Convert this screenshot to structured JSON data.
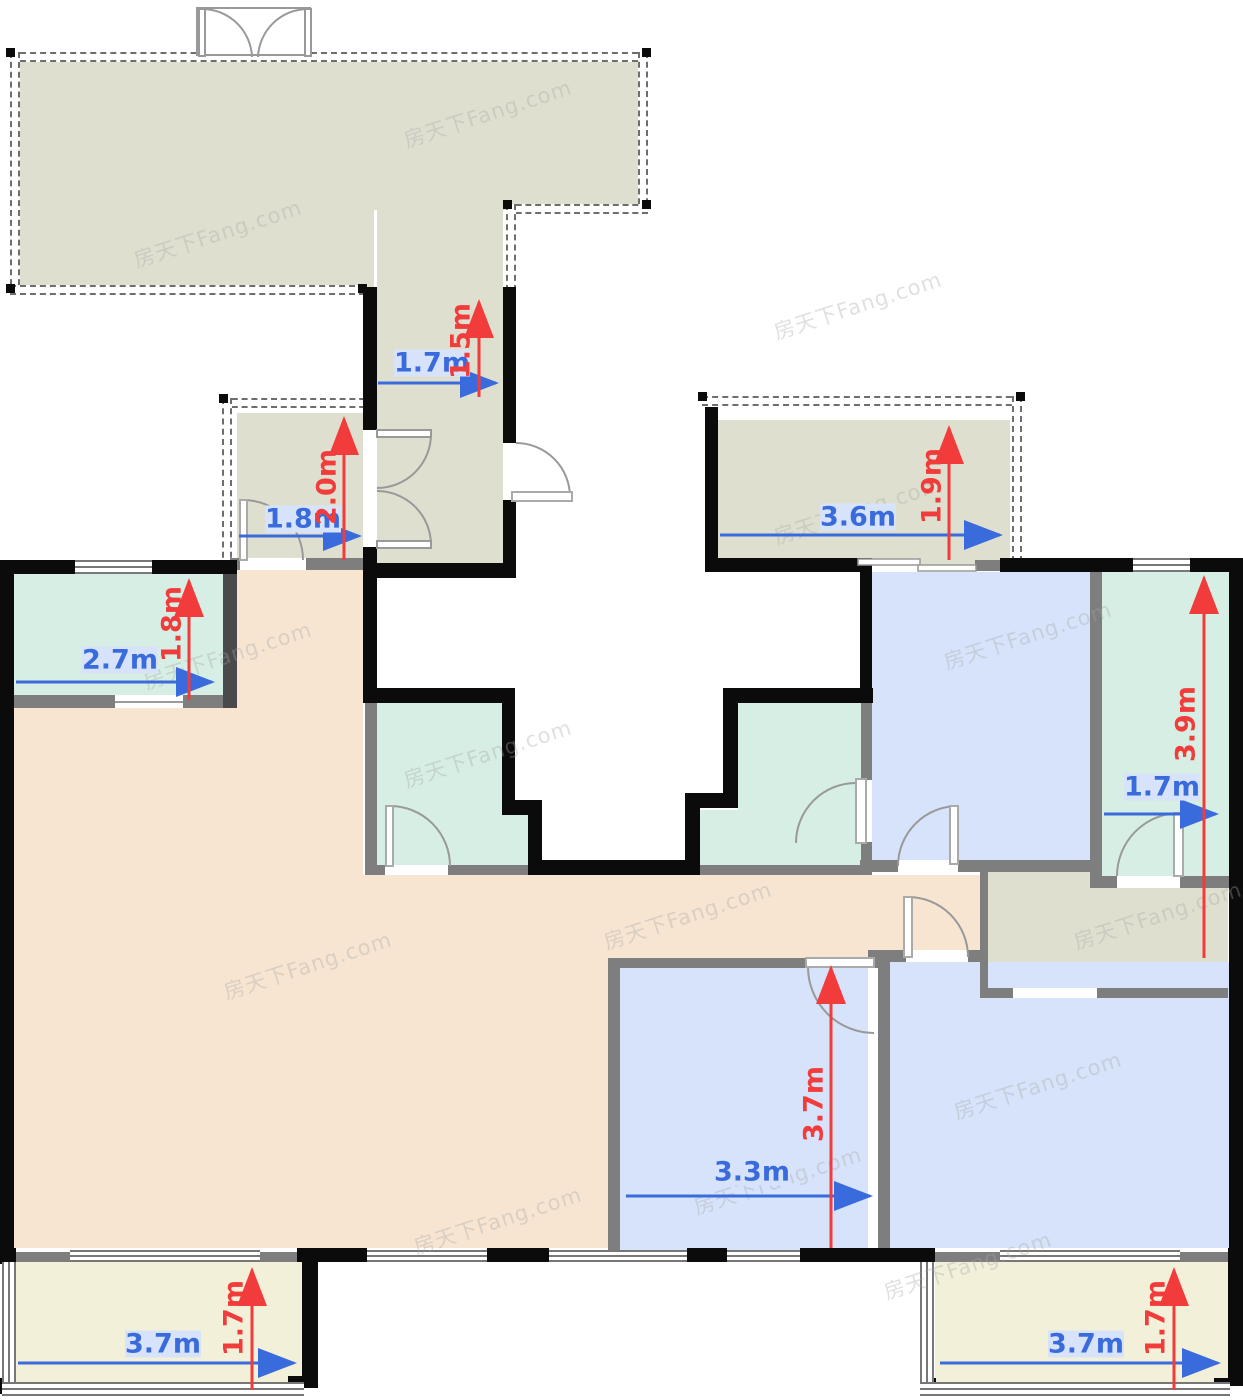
{
  "watermark": {
    "text": "房天下Fang.com"
  },
  "palette": {
    "terrace_khaki": "#DFDFD0",
    "living_beige": "#F7E5D2",
    "bedroom_blue": "#D7E3FA",
    "bath_teal": "#D6EEE3",
    "balcony_cream": "#F2F0D9",
    "wall_black": "#0B0B0B",
    "wall_gray": "#7E7E7E",
    "dim_blue": "#3A6BDC",
    "dim_red": "#F23B3B"
  },
  "dims": [
    {
      "id": "corridor-width",
      "label": "1.7m",
      "axis": "horizontal",
      "color": "blue"
    },
    {
      "id": "corridor-height",
      "label": "1.5m",
      "axis": "vertical",
      "color": "red"
    },
    {
      "id": "storage-room-width",
      "label": "1.8m",
      "axis": "horizontal",
      "color": "blue"
    },
    {
      "id": "storage-room-height",
      "label": "2.0m",
      "axis": "vertical",
      "color": "red"
    },
    {
      "id": "room-top-left-width",
      "label": "2.7m",
      "axis": "horizontal",
      "color": "blue"
    },
    {
      "id": "room-top-left-height",
      "label": "1.8m",
      "axis": "vertical",
      "color": "red"
    },
    {
      "id": "balcony-top-right-width",
      "label": "3.6m",
      "axis": "horizontal",
      "color": "blue"
    },
    {
      "id": "balcony-top-right-height",
      "label": "1.9m",
      "axis": "vertical",
      "color": "red"
    },
    {
      "id": "room-right-width",
      "label": "1.7m",
      "axis": "horizontal",
      "color": "blue"
    },
    {
      "id": "room-right-height",
      "label": "3.9m",
      "axis": "vertical",
      "color": "red"
    },
    {
      "id": "bedroom-middle-width",
      "label": "3.3m",
      "axis": "horizontal",
      "color": "blue"
    },
    {
      "id": "bedroom-middle-height",
      "label": "3.7m",
      "axis": "vertical",
      "color": "red"
    },
    {
      "id": "balcony-bottom-left-width",
      "label": "3.7m",
      "axis": "horizontal",
      "color": "blue"
    },
    {
      "id": "balcony-bottom-left-height",
      "label": "1.7m",
      "axis": "vertical",
      "color": "red"
    },
    {
      "id": "balcony-bottom-right-width",
      "label": "3.7m",
      "axis": "horizontal",
      "color": "blue"
    },
    {
      "id": "balcony-bottom-right-height",
      "label": "1.7m",
      "axis": "vertical",
      "color": "red"
    }
  ]
}
